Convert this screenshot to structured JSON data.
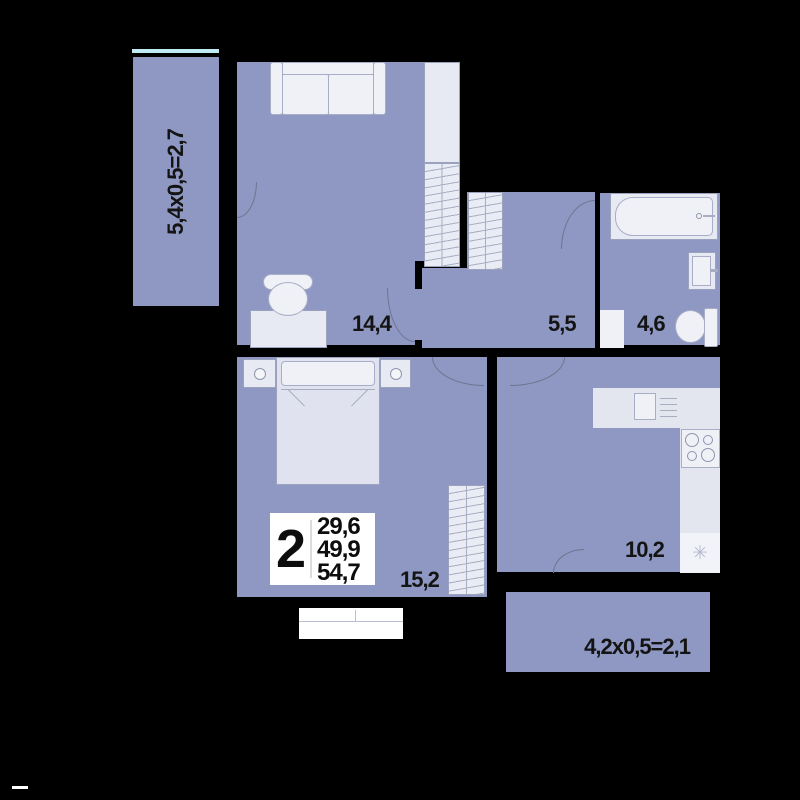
{
  "plan": {
    "type": "apartment-floor-plan",
    "colors": {
      "background": "#000000",
      "floor": "#8e98c2",
      "furniture": "#e7eaf3",
      "wall": "#000000",
      "window_line": "#bfe9f3",
      "text": "#141414"
    },
    "info_box": {
      "rooms": "2",
      "areas": [
        "29,6",
        "49,9",
        "54,7"
      ]
    },
    "rooms": {
      "living": {
        "area": "14,4"
      },
      "hall": {
        "area": "5,5"
      },
      "bathroom": {
        "area": "4,6"
      },
      "bedroom": {
        "area": "15,2"
      },
      "kitchen": {
        "area": "10,2"
      },
      "balcony_left": {
        "formula": "5,4x0,5=2,7"
      },
      "balcony_bottom": {
        "formula": "4,2x0,5=2,1"
      }
    },
    "icons": {
      "kitchen_sink": "✳"
    }
  }
}
